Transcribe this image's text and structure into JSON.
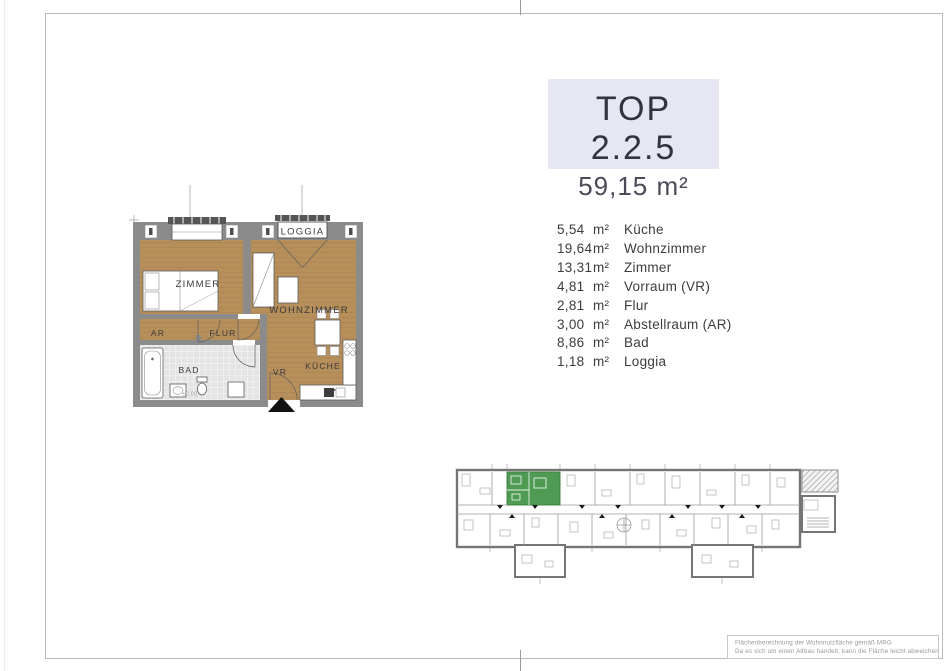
{
  "title_box": {
    "unit": "TOP 2.2.5",
    "area": "59,15 m²"
  },
  "room_list": [
    {
      "area": "5,54",
      "unit": "m²",
      "name": "Küche"
    },
    {
      "area": "19,64",
      "unit": "m²",
      "name": "Wohnzimmer"
    },
    {
      "area": "13,31",
      "unit": "m²",
      "name": "Zimmer"
    },
    {
      "area": "4,81",
      "unit": "m²",
      "name": "Vorraum (VR)"
    },
    {
      "area": "2,81",
      "unit": "m²",
      "name": "Flur"
    },
    {
      "area": "3,00",
      "unit": "m²",
      "name": "Abstellraum (AR)"
    },
    {
      "area": "8,86",
      "unit": "m²",
      "name": "Bad"
    },
    {
      "area": "1,18",
      "unit": "m²",
      "name": "Loggia"
    }
  ],
  "floor_plan": {
    "labels": {
      "loggia": "LOGGIA",
      "zimmer": "ZIMMER",
      "wohnzimmer": "WOHNZIMMER",
      "ar": "AR",
      "flur": "FLUR",
      "bad": "BAD",
      "vr": "VR",
      "kueche": "KÜCHE",
      "level": "±0.00"
    }
  },
  "footer": {
    "line1": "Flächenberechnung der Wohnnutzfläche gemäß MRG",
    "line2": "Da es sich um einen Altbau handelt, kann die Fläche leicht abweichen"
  },
  "colors": {
    "accent_green": "#4f9b53",
    "floor_wood": "#b78f5a",
    "wall_gray": "#8b8b8b",
    "tile_gray": "#e4e4e4",
    "title_box_bg": "#e7e7f3"
  }
}
